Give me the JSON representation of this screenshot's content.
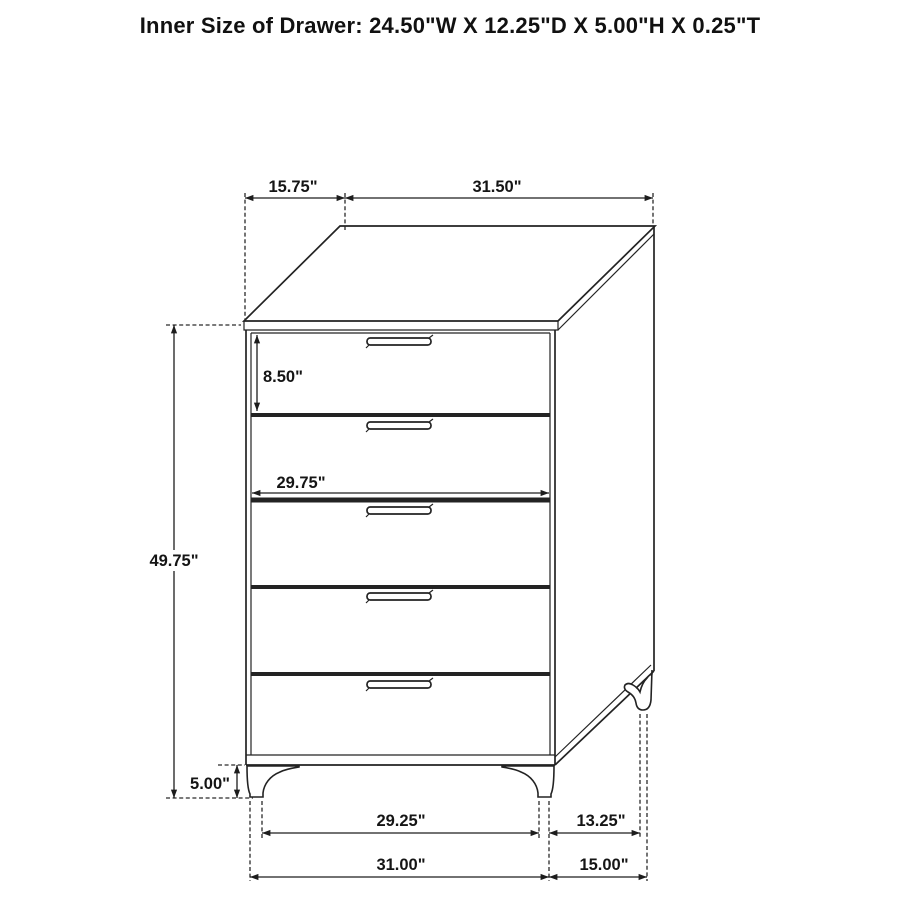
{
  "title": "Inner Size of Drawer: 24.50\"W X 12.25\"D X 5.00\"H X 0.25\"T",
  "diagram": {
    "item": "5-drawer chest dimension diagram",
    "drawer_count": 5,
    "line_color": "#232323",
    "background_color": "#ffffff"
  },
  "dimensions": {
    "top_depth": "15.75\"",
    "top_width": "31.50\"",
    "top_drawer_height": "8.50\"",
    "drawer_front_width": "29.75\"",
    "case_height": "49.75\"",
    "leg_height": "5.00\"",
    "front_leg_spacing": "29.25\"",
    "side_leg_spacing": "13.25\"",
    "overall_width": "31.00\"",
    "overall_depth": "15.00\""
  }
}
